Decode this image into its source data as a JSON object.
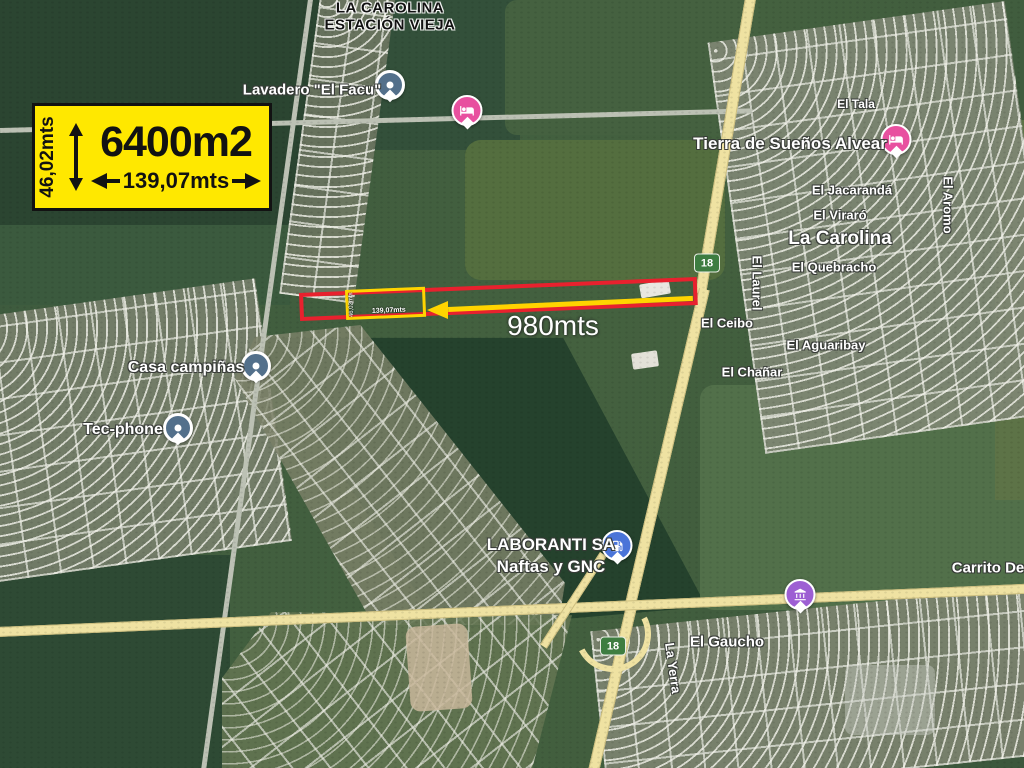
{
  "annotation": {
    "area_box": {
      "area": "6400m2",
      "width": "139,07mts",
      "depth": "46,02mts"
    },
    "parcel_highlight": {
      "width": "139,07mts",
      "depth": "46,02mts"
    },
    "distance": "980mts",
    "colors": {
      "parcel_outline": "#e8212e",
      "highlight": "#ffd400",
      "info_box_bg": "#ffe800"
    }
  },
  "map": {
    "station": {
      "line1": "LA CAROLINA",
      "line2": "ESTACIÓN VIEJA"
    },
    "town": "La Carolina",
    "route_shield": "18",
    "streets": {
      "el_tala": "El Tala",
      "el_jacaranda": "El Jacarandá",
      "el_viraro": "El Viraró",
      "el_aromo": "El Aromo",
      "el_quebracho": "El Quebracho",
      "el_laurel": "El Laurel",
      "el_ceibo": "El Ceibo",
      "el_aguaribay": "El Aguaribay",
      "el_chanar": "El Chañar",
      "el_gaucho": "El Gaucho",
      "la_yerra": "La Yerra"
    },
    "pois": {
      "lavadero": "Lavadero \"El Facu\"",
      "tierra_suenos": "Tierra de Sueños Alvear",
      "casa_campinas": "Casa campiñas",
      "tec_phone": "Tec-phone",
      "laboranti_line1": "LABORANTI SA",
      "laboranti_line2": "Naftas y GNC",
      "carrito": "Carrito De"
    },
    "icons": {
      "lodging": "bed-icon",
      "gas": "fuel-pump-icon",
      "landmark": "landmark-icon",
      "business": "dot-pin-icon"
    },
    "pin_colors": {
      "lodging": "#e8509f",
      "gas": "#4a74d8",
      "landmark": "#9d5fd3",
      "business": "#53708b",
      "shield": "#3e7d41"
    }
  }
}
